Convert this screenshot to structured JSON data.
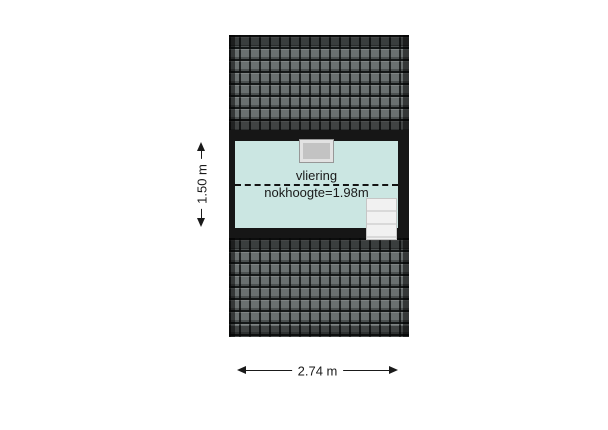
{
  "room": {
    "name": "vliering",
    "ridge_height": "nokhoogte=1.98m"
  },
  "dimensions": {
    "height": "1.50 m",
    "width": "2.74 m"
  },
  "features": {
    "skylight_icon": "skylight-window",
    "stairs_icon": "staircase",
    "ridge_line": "dashed-ridge-line"
  },
  "colors": {
    "background": "#ffffff",
    "room_fill": "#cbe6e2",
    "wall": "#161616",
    "roof_tile": "#6a7070",
    "roof_gap": "#141616",
    "skylight_fill": "#c3c3c3",
    "skylight_frame": "#e2e2e2",
    "stairs_fill": "#f1f1f1",
    "dimension_line": "#1a1a1a"
  }
}
